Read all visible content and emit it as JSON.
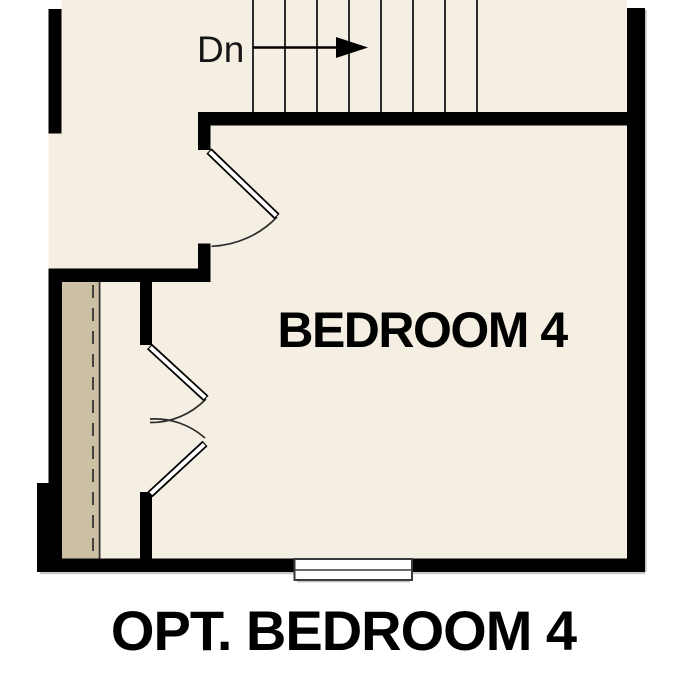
{
  "page": {
    "background": "#ffffff"
  },
  "floor_plan": {
    "labels": {
      "stairs_direction": "Dn",
      "room_name": "BEDROOM 4",
      "caption": "OPT. BEDROOM 4"
    },
    "stairs": {
      "tread_count": 8
    },
    "colors": {
      "page_background": "#ffffff",
      "floor": "#f5eee2",
      "closet_floor": "#cbbfa4",
      "wall": "#000000",
      "line": "#2d2d2d",
      "window_frame": "#3a3a3a",
      "shadow": "#9b9b9b",
      "text": "#000000"
    }
  }
}
